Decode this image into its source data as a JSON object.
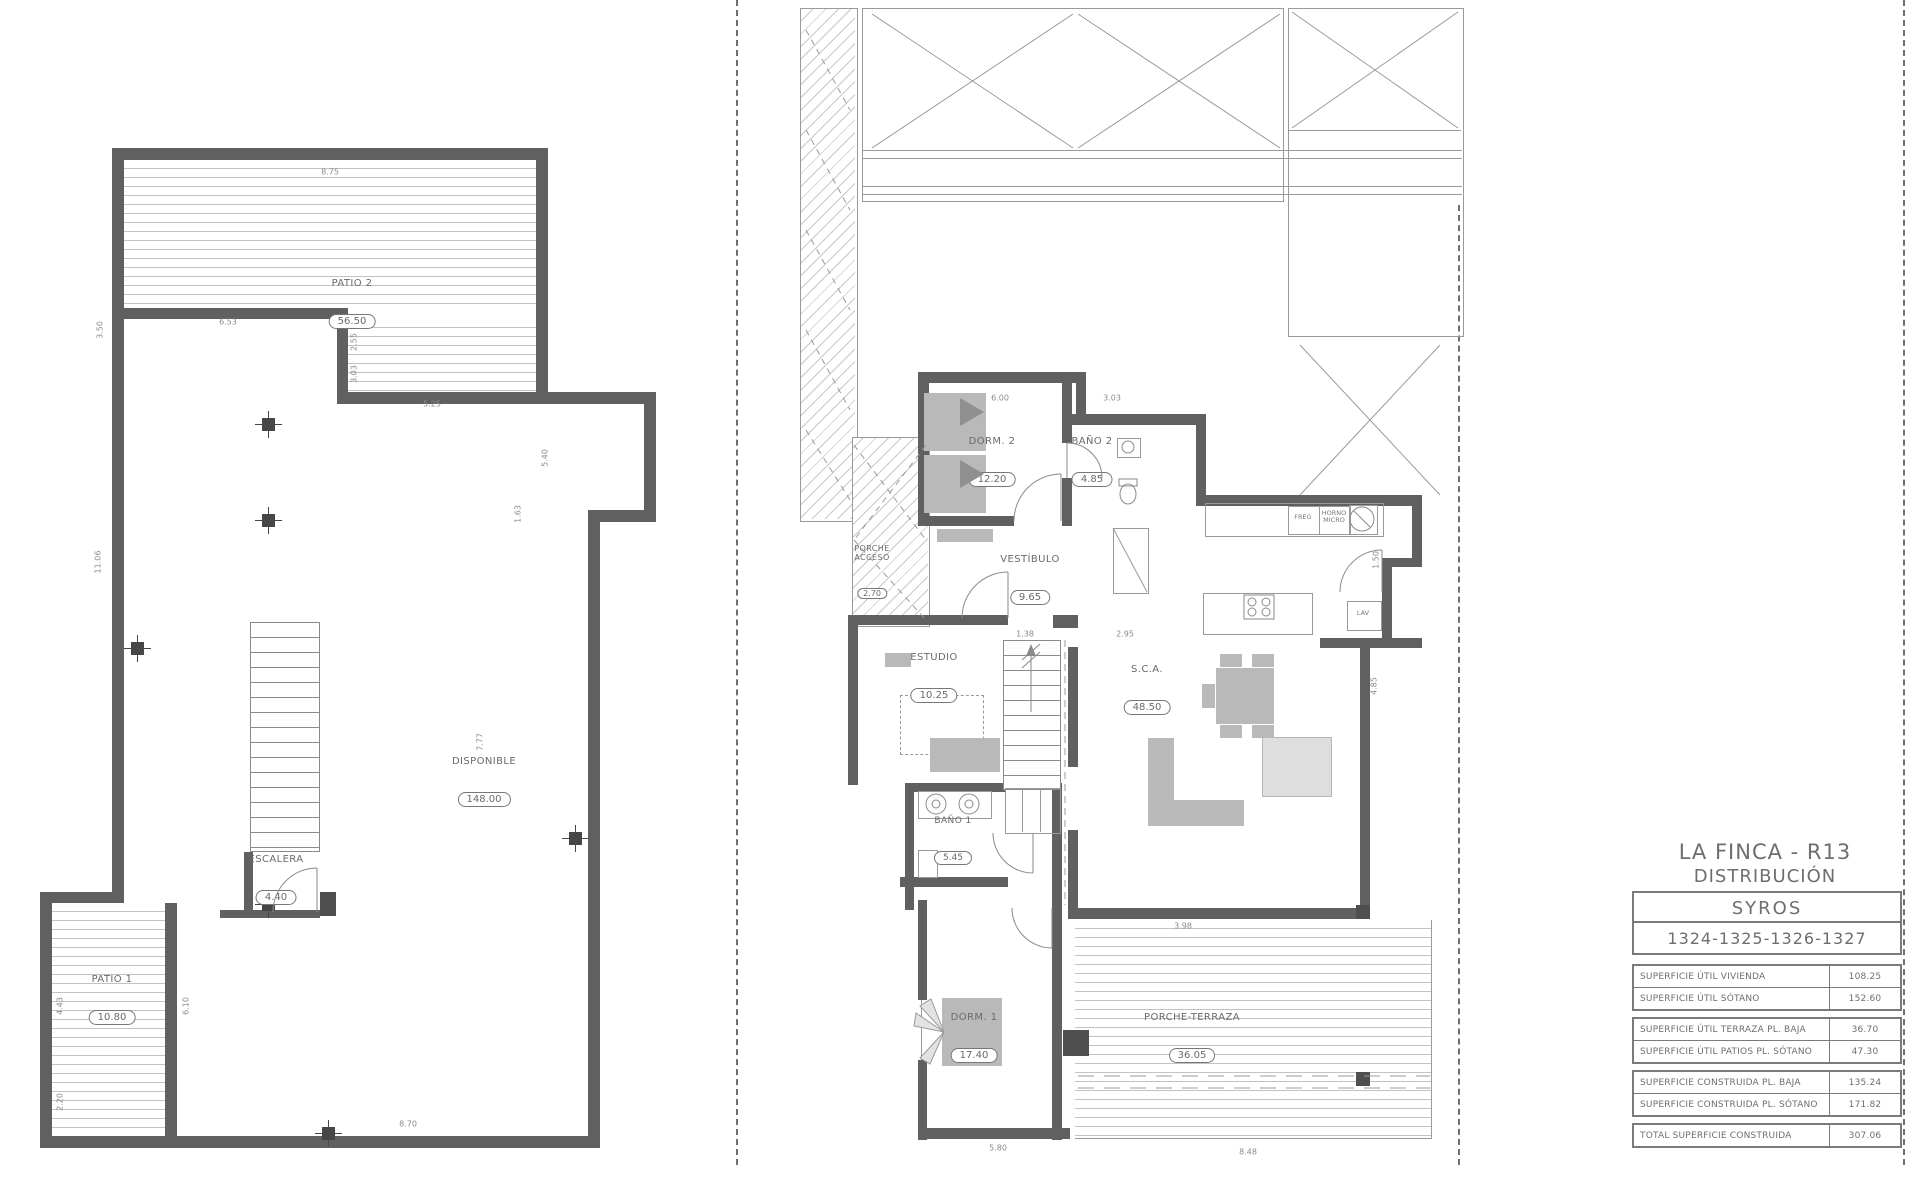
{
  "title_block": {
    "project": "LA FINCA - R13",
    "sheet": "DISTRIBUCIÓN",
    "model": "SYROS",
    "units": "1324-1325-1326-1327"
  },
  "areas": {
    "rows": [
      {
        "label": "SUPERFICIE ÚTIL VIVIENDA",
        "value": "108.25"
      },
      {
        "label": "SUPERFICIE ÚTIL SÓTANO",
        "value": "152.60"
      },
      {
        "label": "SUPERFICIE ÚTIL TERRAZA PL. BAJA",
        "value": "36.70"
      },
      {
        "label": "SUPERFICIE ÚTIL PATIOS PL. SÓTANO",
        "value": "47.30"
      },
      {
        "label": "SUPERFICIE CONSTRUIDA PL. BAJA",
        "value": "135.24"
      },
      {
        "label": "SUPERFICIE CONSTRUIDA PL. SÓTANO",
        "value": "171.82"
      },
      {
        "label": "TOTAL SUPERFICIE CONSTRUIDA",
        "value": "307.06"
      }
    ]
  },
  "basement": {
    "rooms": {
      "patio2": {
        "name": "PATIO 2",
        "area": "56.50"
      },
      "disponible": {
        "name": "DISPONIBLE",
        "area": "148.00"
      },
      "escalera": {
        "name": "ESCALERA",
        "area": "4.40"
      },
      "patio1": {
        "name": "PATIO 1",
        "area": "10.80"
      }
    },
    "dims": [
      "8.75",
      "3.50",
      "6.53",
      "2.55",
      "3.03",
      "5.25",
      "5.40",
      "1.63",
      "11.06",
      "7.77",
      "4.43",
      "6.10",
      "2.20",
      "8.70"
    ]
  },
  "ground": {
    "rooms": {
      "dorm2": {
        "name": "DORM. 2",
        "area": "12.20"
      },
      "bano2": {
        "name": "BAÑO 2",
        "area": "4.85"
      },
      "vestibulo": {
        "name": "VESTÍBULO",
        "area": "9.65"
      },
      "porche_acceso": {
        "name": "PORCHE\nACCESO",
        "area": "2.70"
      },
      "estudio": {
        "name": "ESTUDIO",
        "area": "10.25"
      },
      "sca": {
        "name": "S.C.A.",
        "area": "48.50"
      },
      "bano1": {
        "name": "BAÑO 1",
        "area": "5.45"
      },
      "dorm1": {
        "name": "DORM. 1",
        "area": "17.40"
      },
      "terraza": {
        "name": "PORCHE-TERRAZA",
        "area": "36.05"
      }
    },
    "kitchen": {
      "freg": "FREG",
      "horno": "HORNO\nMICRO",
      "lav": "LAV"
    },
    "dims": [
      "6.00",
      "3.03",
      "1.38",
      "2.95",
      "1.50",
      "4.85",
      "3.98",
      "5.80",
      "8.48"
    ]
  }
}
